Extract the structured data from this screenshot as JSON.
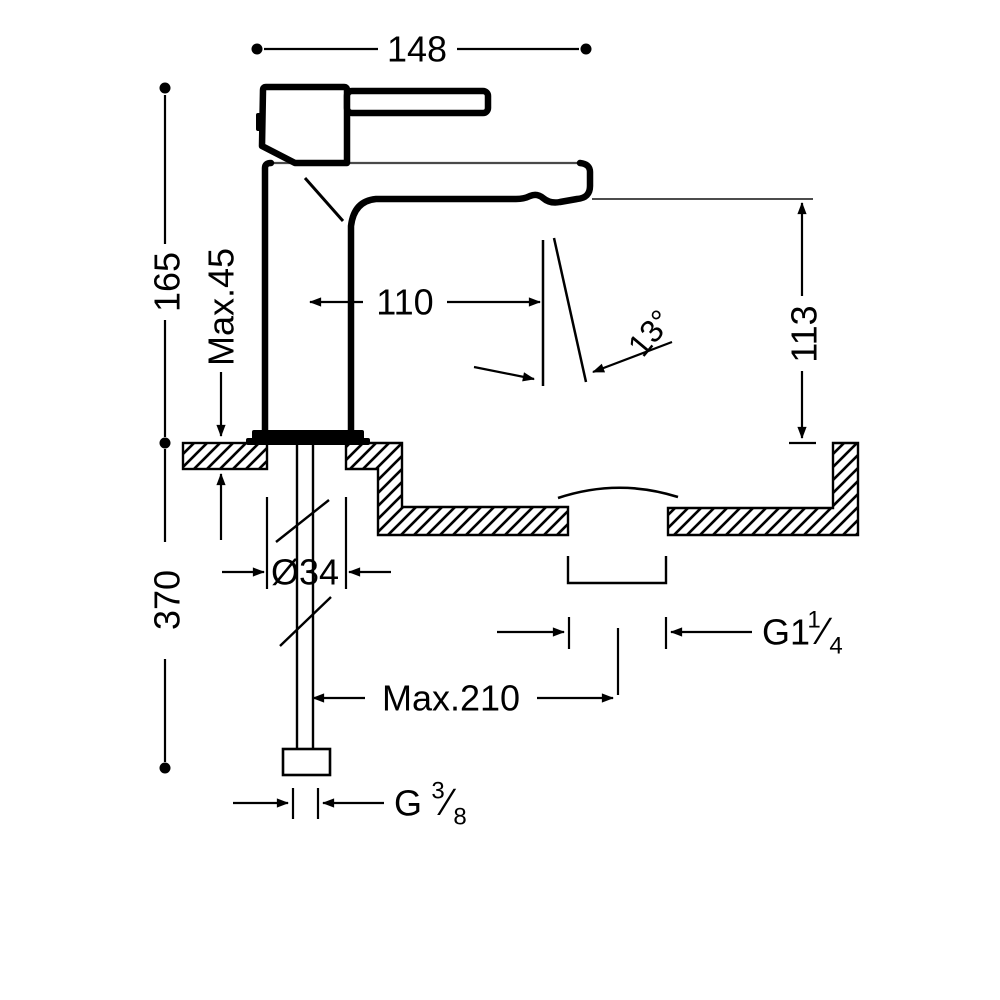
{
  "figure": {
    "type": "technical-drawing",
    "subject": "Single-lever basin mixer tap — side elevation with installation dimensions",
    "line_color": "#000000",
    "background_color": "#ffffff"
  },
  "labels": {
    "spout_width": "148",
    "body_height": "165",
    "deck_thickness": "Max.45",
    "spout_reach": "110",
    "stream_angle": "13°",
    "outlet_height": "113",
    "hole_diameter": "Ø34",
    "under_depth": "370",
    "drain_prefix": "G1",
    "drain_num": "1",
    "drain_slash": "⁄",
    "drain_den": "4",
    "hose_length": "Max.210",
    "supply_prefix": "G",
    "supply_num": "3",
    "supply_slash": "⁄",
    "supply_den": "8"
  }
}
